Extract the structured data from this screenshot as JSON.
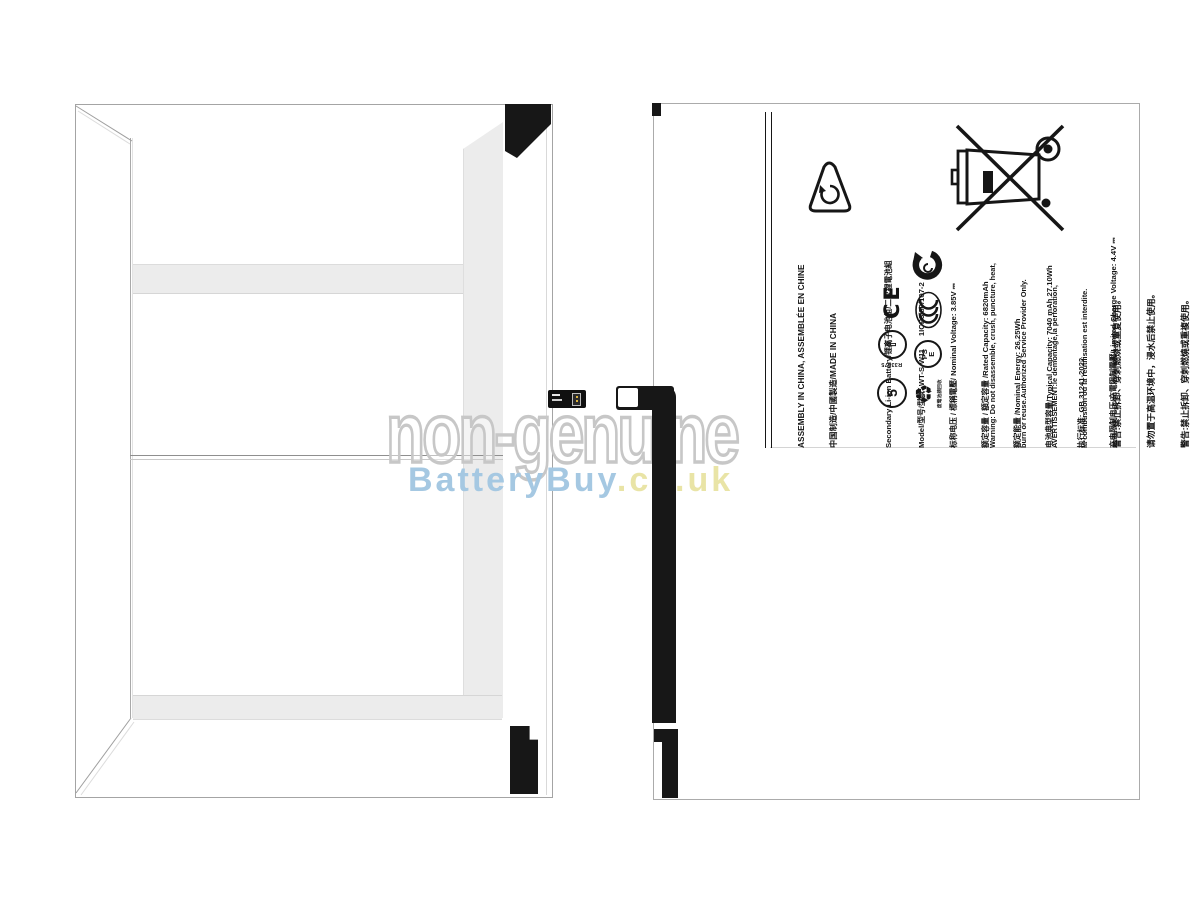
{
  "watermark": {
    "line1": "non-genuine",
    "brand": "BatteryBuy",
    "tld": ".co.uk",
    "outline_color": "#c7c7c7",
    "brand_color": "#a5c8e2",
    "tld_color": "#e9e4a6"
  },
  "label": {
    "header": {
      "line1": "ASSEMBLY IN CHINA, ASSEMBLÉE EN CHINE",
      "line2": "中国制造/中國製造/MADE IN CHINA"
    },
    "specs": [
      "Secondary Li-ion Battery/锂离子电池组/二次鋰電池組",
      "Model/型号/型號: WT-S-W11      1ICP3/80/107-2",
      "标称电压 / 標稱電壓/ Nominal Voltage: 3.85V ⎓",
      "额定容量 / 額定容量 /Rated Capacity: 6820mAh",
      "额定能量 /Nominal Energy: 26.25Wh",
      "电池典型容量/Typical Capacity: 7040 mAh 27.10Wh",
      "执行标准: GB 31241-2022",
      "充电限制电压/充電限制電壓/Limited Charge Voltage: 4.4V ⎓"
    ],
    "warnings": [
      "Warning: Do not disassemble, crush, puncture, heat,",
      "burn or reuse.Authorized Service Provider Only.",
      "AVERTISSEMENT:le demontage,la perforation,",
      "la combustion ou la reutilisation est interdite.",
      "警告:禁止拆卸、穿刺燃烧或重复使用。",
      "请勿置于高温环境中，浸水后禁止使用。",
      "警告:禁止拆卸、穿刺燃燒或重複使用。",
      "請勿置於高溫環境中，浸水後禁止使用。"
    ],
    "marks": {
      "ce": "CE",
      "bsmi_number": "R33475",
      "bsmi_arrow": "⇧",
      "rohs_number": "5",
      "pse_line1": "PS",
      "pse_line2": "E",
      "battery_recycle_glyph": "♻",
      "battery_recycle_caption": "废電池請回收"
    }
  }
}
